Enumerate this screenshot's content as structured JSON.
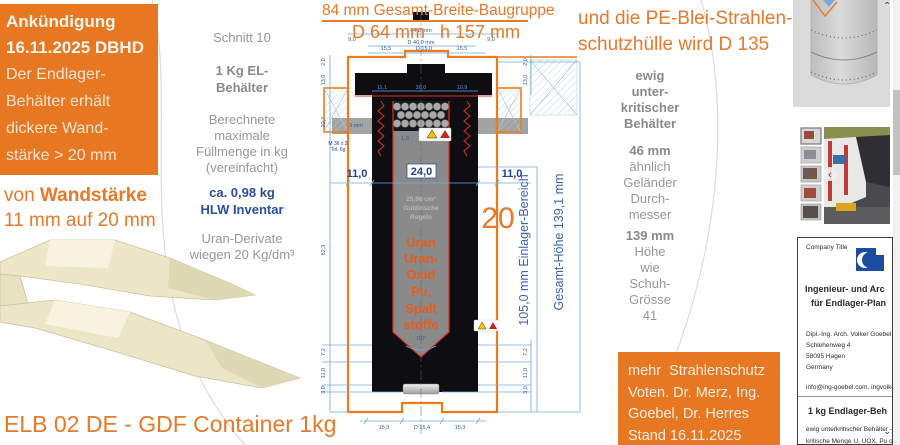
{
  "colors": {
    "accent_orange": "#E87722",
    "drawing_orange": "#EE7A18",
    "dim_line_blue": "#74A9DC",
    "dim_label_blue": "#1F3F94",
    "uran_orange": "#E85A1E",
    "logo_blue": "#1D4CA0"
  },
  "announcement": {
    "title1": "Ankündigung",
    "title2": "16.11.2025 DBHD",
    "body1": "Der Endlager-",
    "body2": "Behälter erhält",
    "body3": "dickere Wand-",
    "body4": "stärke > 20 mm"
  },
  "wall_note": {
    "prefix": "von ",
    "bold": "Wandstärke",
    "line2": "11 mm auf 20 mm"
  },
  "left_col": {
    "schnitt": "Schnitt 10",
    "el1": "1 Kg EL-",
    "el2": "Behälter",
    "calc1": "Berechnete",
    "calc2": "maximale",
    "calc3": "Füllmenge in kg",
    "calc4": "(vereinfacht)",
    "inv1": "ca. 0,98 kg",
    "inv2": "HLW Inventar",
    "uran1": "Uran-Derivate",
    "uran2": "wiegen 20 Kg/dm³"
  },
  "drawing": {
    "title": "84 mm Gesamt-Breite-Baugruppe",
    "subtitle": "D 64 mm   h 157 mm",
    "num20": "20",
    "einlager": "105,0 mm  Einlager-Bereich",
    "gesamt": "Gesamt-Höhe  139,1 mm",
    "core": {
      "vol": "25,98 cm³",
      "g1": "Guldinsche",
      "g2": "Regeln",
      "u1": "Uran",
      "u2": "Uran-",
      "u3": "Oxid",
      "u4": "Pu,",
      "u5": "Spalt",
      "u6": "stoffe"
    },
    "dims": {
      "d64": "64,0 mm",
      "d46": "D 46,0 mm",
      "n90l": "9,0",
      "n90r": "9,0",
      "w155l": "15,5",
      "d150": "D 15,0",
      "w155r": "15,5",
      "r2l": "11,1",
      "r2c": "30,0",
      "r2r": "10,9",
      "wl": "11,0",
      "core": "24,0",
      "wr": "11,0",
      "thread1": "M 36 x 2",
      "thread2": "Tol. 6g",
      "nine": "9 mm",
      "one0": "1,0",
      "angle": "110°",
      "b1": "15,3",
      "b2": "D 15,4",
      "b3": "15,3",
      "l20": "2,0",
      "l130": "13,0",
      "l227": "22,7",
      "l823": "82,3",
      "l72": "7,2",
      "l110": "11,0",
      "l30": "3,0",
      "r20": "2,0",
      "r130": "13,0",
      "r72": "7,2",
      "r110": "11,0",
      "r30": "3,0"
    }
  },
  "right_note": {
    "line1": "und die PE-Blei-Strahlen-",
    "line2": "schutzhülle wird D 135"
  },
  "right_col": {
    "e1": "ewig",
    "e2": "unter-",
    "e3": "kritischer",
    "e4": "Behälter",
    "mm46": "46 mm",
    "g1": "ähnlich",
    "g2": "Geländer",
    "g3": "Durch-",
    "g4": "messer",
    "mm139": "139 mm",
    "s1": "Höhe",
    "s2": "wie",
    "s3": "Schuh-",
    "s4": "Grösse",
    "s5": "41"
  },
  "vote_box": {
    "line1": "mehr  Strahlenschutz",
    "line2": "Voten. Dr. Merz, Ing.",
    "line3": "Goebel, Dr. Herres",
    "line4": "Stand 16.11.2025"
  },
  "footer_title": "ELB 02 DE - GDF Container 1kg",
  "card": {
    "company": "Company Title",
    "h1": "Ingenieur- und Arc",
    "h2": "für Endlager-Plan",
    "person": "Dipl.-Ing. Arch. Volker Goebel",
    "street": "Schlehenweg 4",
    "city": "58095 Hagen",
    "country": "Germany",
    "email": "info@ing-goebel.com, ingvolke",
    "product": "1 kg Endlager-Beh",
    "d1": "ewig unterkritischer Behälter -",
    "d2": "kritische Menge U, UOX, Pu o"
  },
  "scroll": {
    "up": "ˆ",
    "down": "ˇ"
  },
  "gallery": {
    "back": "‹"
  }
}
